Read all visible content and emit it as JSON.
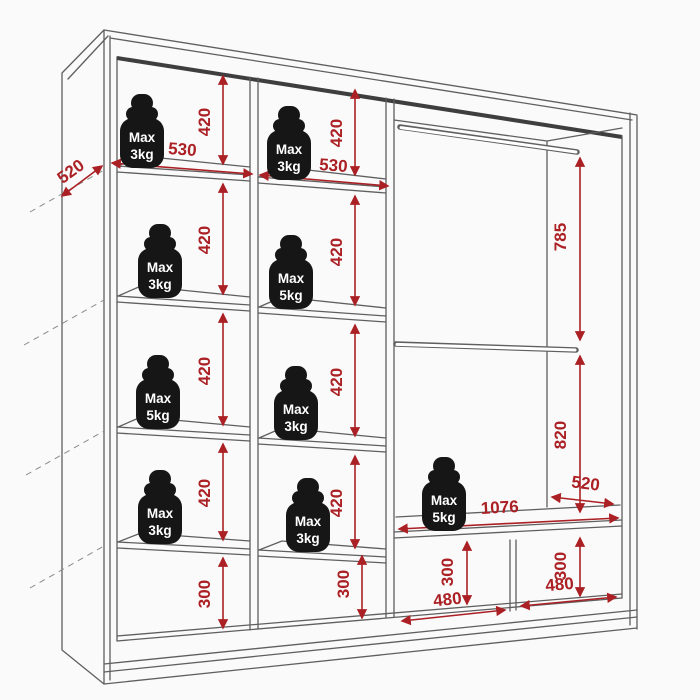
{
  "diagram": {
    "kind": "wardrobe-interior-dimension-drawing",
    "background_color": "#fafafa",
    "line_color": "#5f5f5f",
    "dimension_color": "#ab2024",
    "weight_color": "#161616"
  },
  "dimensions": {
    "side_depth": "520",
    "column1": {
      "width": "530",
      "cell_heights": [
        "420",
        "420",
        "420",
        "420",
        "300"
      ]
    },
    "column2": {
      "width": "530",
      "cell_heights": [
        "420",
        "420",
        "420",
        "420",
        "300"
      ]
    },
    "hanging_section": {
      "upper_rod_height": "785",
      "lower_rod_height": "820",
      "shelf_depth": "520",
      "shelf_width": "1076",
      "compartments": [
        {
          "height": "300",
          "width": "480"
        },
        {
          "height": "300",
          "width": "480"
        }
      ]
    }
  },
  "weights": {
    "column1": [
      {
        "line1": "Max",
        "line2": "3kg"
      },
      {
        "line1": "Max",
        "line2": "3kg"
      },
      {
        "line1": "Max",
        "line2": "5kg"
      },
      {
        "line1": "Max",
        "line2": "3kg"
      }
    ],
    "column2": [
      {
        "line1": "Max",
        "line2": "3kg"
      },
      {
        "line1": "Max",
        "line2": "5kg"
      },
      {
        "line1": "Max",
        "line2": "3kg"
      },
      {
        "line1": "Max",
        "line2": "3kg"
      }
    ],
    "shelf": [
      {
        "line1": "Max",
        "line2": "5kg"
      }
    ]
  }
}
